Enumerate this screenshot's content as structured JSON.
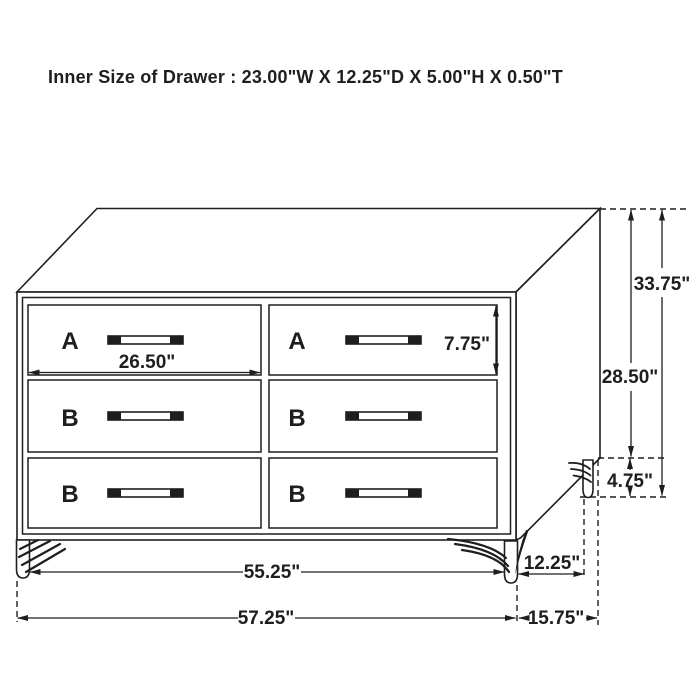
{
  "title": "Inner Size of Drawer : 23.00\"W X 12.25\"D X 5.00\"H X 0.50\"T",
  "colors": {
    "line": "#1e1e1e",
    "accent_red": "#c9252b",
    "background": "#ffffff"
  },
  "drawers": {
    "left_column": [
      "A",
      "B",
      "B"
    ],
    "right_column": [
      "A",
      "B",
      "B"
    ]
  },
  "dimensions": {
    "drawer_front_width": "26.50\"",
    "drawer_front_height": "7.75\"",
    "overall_height": "33.75\"",
    "case_height": "28.50\"",
    "leg_height": "4.75\"",
    "between_legs_width": "55.25\"",
    "overall_width": "57.25\"",
    "leg_inset_depth": "12.25\"",
    "overall_depth": "15.75\""
  }
}
